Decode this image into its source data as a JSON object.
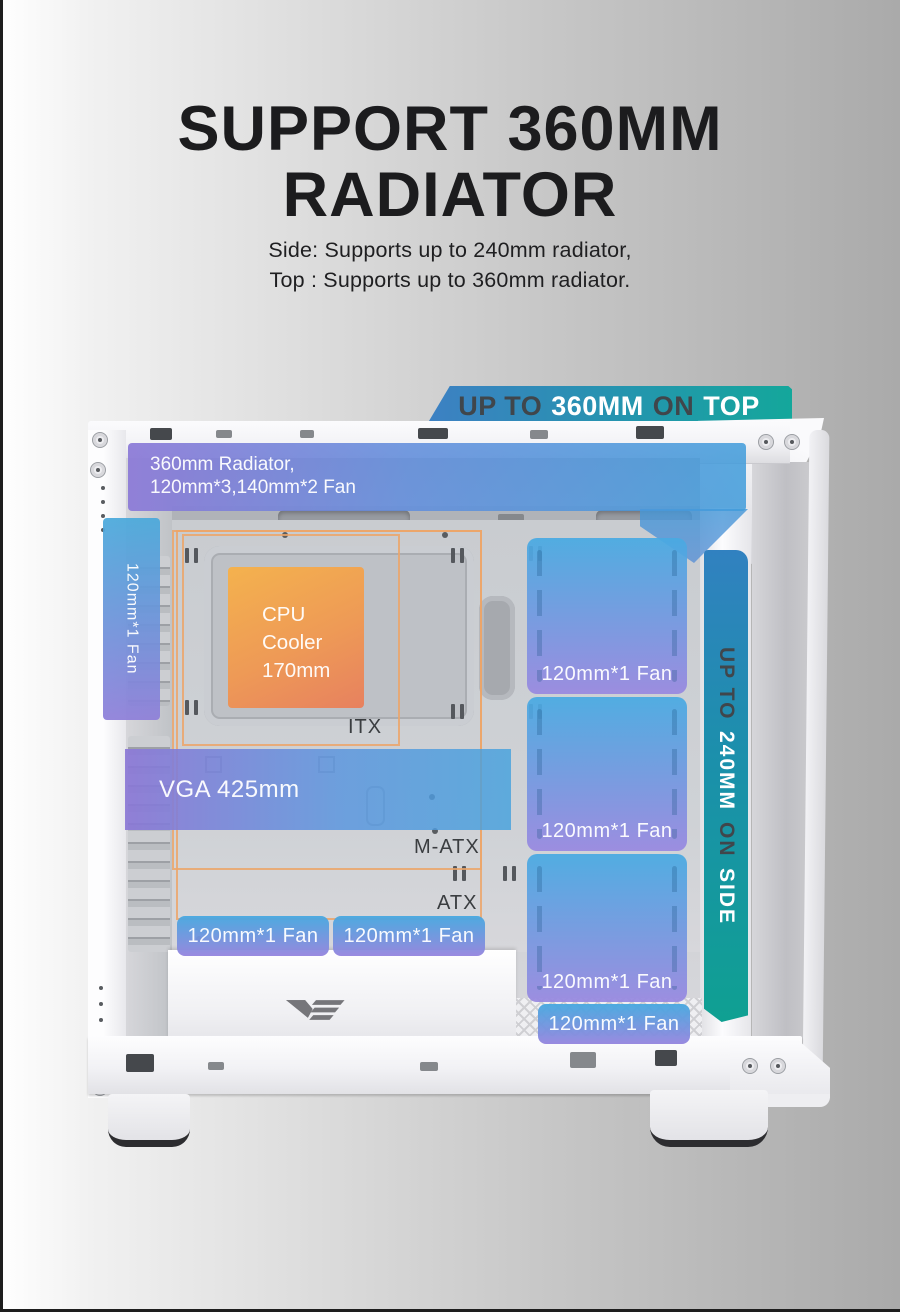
{
  "page": {
    "title_line1": "SUPPORT 360MM",
    "title_line2": "RADIATOR",
    "subtitle_line1": "Side: Supports up to 240mm radiator,",
    "subtitle_line2": "Top : Supports up to 360mm radiator."
  },
  "banner_top": {
    "word1": "UP TO",
    "word2": "360MM",
    "word3": "ON",
    "word4": "TOP"
  },
  "banner_side": {
    "word1": "UP TO",
    "word2": "240MM",
    "word3": "ON",
    "word4": "SIDE"
  },
  "overlays": {
    "top_radiator_line1": "360mm Radiator,",
    "top_radiator_line2": "120mm*3,140mm*2 Fan",
    "fan_single": "120mm*1 Fan",
    "cpu_cooler": "CPU Cooler 170mm",
    "vga": "VGA 425mm"
  },
  "board_labels": {
    "itx": "ITX",
    "matx": "M-ATX",
    "atx": "ATX"
  },
  "colors": {
    "banner_blue": "#3d80c3",
    "banner_teal": "#14a79b",
    "overlay_purple": "#8b79d7",
    "overlay_blue": "#409cdb",
    "cpu_orange_start": "#f4b24e",
    "cpu_orange_end": "#e7815f",
    "outline_orange": "#eca468",
    "dark_word_text": "#40464b",
    "title_text": "#1c1c1e"
  }
}
